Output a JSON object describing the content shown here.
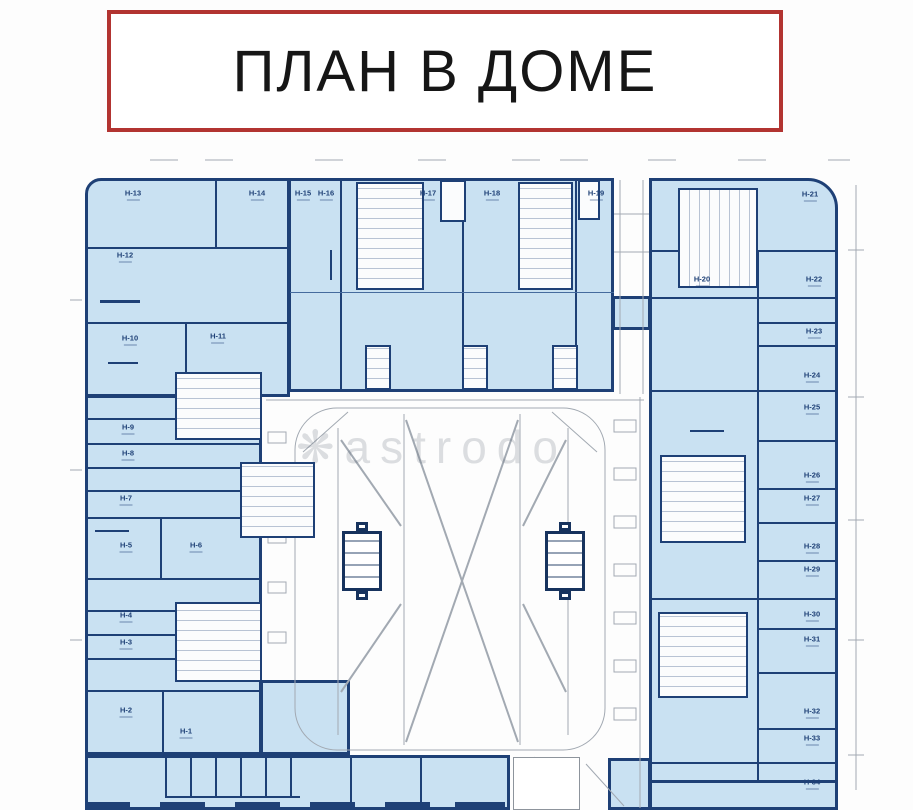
{
  "title": {
    "text": "ПЛАН В ДОМЕ"
  },
  "watermark": {
    "icon_name": "flower-asterisk-icon",
    "icon_glyph": "❋",
    "text": "astrodo"
  },
  "plan": {
    "colors": {
      "unit_fill": "#c9e1f2",
      "wall_navy": "#1e4076",
      "title_border_red": "#b23431",
      "courtyard_line_gray": "#a2a9b2"
    },
    "units": [
      {
        "id": "Н-1",
        "x": 186,
        "y": 733
      },
      {
        "id": "Н-2",
        "x": 126,
        "y": 712
      },
      {
        "id": "Н-3",
        "x": 126,
        "y": 644
      },
      {
        "id": "Н-4",
        "x": 126,
        "y": 617
      },
      {
        "id": "Н-5",
        "x": 126,
        "y": 547
      },
      {
        "id": "Н-6",
        "x": 196,
        "y": 547
      },
      {
        "id": "Н-7",
        "x": 126,
        "y": 500
      },
      {
        "id": "Н-8",
        "x": 128,
        "y": 455
      },
      {
        "id": "Н-9",
        "x": 128,
        "y": 429
      },
      {
        "id": "Н-10",
        "x": 130,
        "y": 340
      },
      {
        "id": "Н-11",
        "x": 218,
        "y": 338
      },
      {
        "id": "Н-12",
        "x": 125,
        "y": 257
      },
      {
        "id": "Н-13",
        "x": 133,
        "y": 195
      },
      {
        "id": "Н-14",
        "x": 257,
        "y": 195
      },
      {
        "id": "Н-15",
        "x": 303,
        "y": 195
      },
      {
        "id": "Н-16",
        "x": 326,
        "y": 195
      },
      {
        "id": "Н-17",
        "x": 428,
        "y": 195
      },
      {
        "id": "Н-18",
        "x": 492,
        "y": 195
      },
      {
        "id": "Н-19",
        "x": 596,
        "y": 195
      },
      {
        "id": "Н-20",
        "x": 702,
        "y": 281
      },
      {
        "id": "Н-21",
        "x": 810,
        "y": 196
      },
      {
        "id": "Н-22",
        "x": 814,
        "y": 281
      },
      {
        "id": "Н-23",
        "x": 814,
        "y": 333
      },
      {
        "id": "Н-24",
        "x": 812,
        "y": 377
      },
      {
        "id": "Н-25",
        "x": 812,
        "y": 409
      },
      {
        "id": "Н-26",
        "x": 812,
        "y": 477
      },
      {
        "id": "Н-27",
        "x": 812,
        "y": 500
      },
      {
        "id": "Н-28",
        "x": 812,
        "y": 548
      },
      {
        "id": "Н-29",
        "x": 812,
        "y": 571
      },
      {
        "id": "Н-30",
        "x": 812,
        "y": 616
      },
      {
        "id": "Н-31",
        "x": 812,
        "y": 641
      },
      {
        "id": "Н-32",
        "x": 812,
        "y": 713
      },
      {
        "id": "Н-33",
        "x": 812,
        "y": 740
      },
      {
        "id": "Н-34",
        "x": 812,
        "y": 784
      }
    ]
  }
}
